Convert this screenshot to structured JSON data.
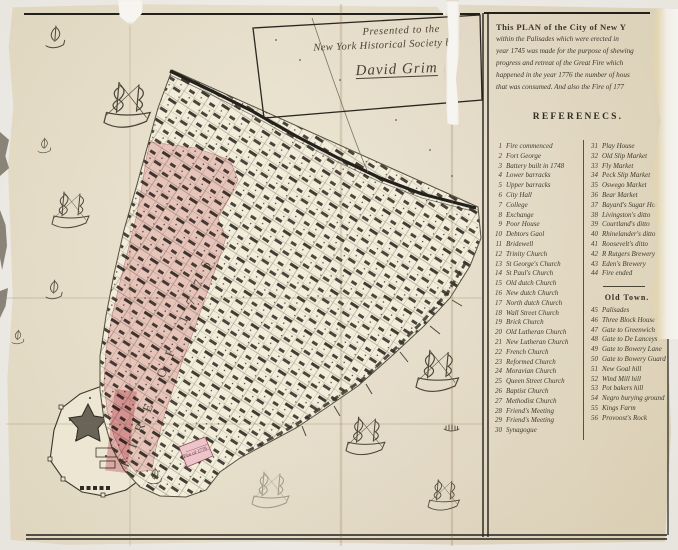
{
  "presentation_note": {
    "line1": "Presented to the",
    "line2": "New York Historical Society by",
    "signature": "David Grim"
  },
  "title_block": {
    "lines": [
      "This PLAN of the City of New Y",
      "within the Palisades which were erected in",
      "year 1745 was made for the purpose of shewing",
      "progress and retreat of the Great Fire which",
      "happened in the year 1776 the number of hous",
      "that was consumed. And also the Fire of 177"
    ]
  },
  "references": {
    "heading": "REFERENECS.",
    "left_column": [
      {
        "num": "1",
        "label": "Fire commenced"
      },
      {
        "num": "2",
        "label": "Fort George"
      },
      {
        "num": "3",
        "label": "Battery built in 1748"
      },
      {
        "num": "4",
        "label": "Lower barracks"
      },
      {
        "num": "5",
        "label": "Upper barracks"
      },
      {
        "num": "6",
        "label": "City Hall"
      },
      {
        "num": "7",
        "label": "College"
      },
      {
        "num": "8",
        "label": "Exchange"
      },
      {
        "num": "9",
        "label": "Poor House"
      },
      {
        "num": "10",
        "label": "Debtors Gaol"
      },
      {
        "num": "11",
        "label": "Bridewell"
      },
      {
        "num": "12",
        "label": "Trinity Church"
      },
      {
        "num": "13",
        "label": "St George's Church"
      },
      {
        "num": "14",
        "label": "St Paul's Church"
      },
      {
        "num": "15",
        "label": "Old dutch Church"
      },
      {
        "num": "16",
        "label": "New dutch Church"
      },
      {
        "num": "17",
        "label": "North dutch Church"
      },
      {
        "num": "18",
        "label": "Wall Street Church"
      },
      {
        "num": "19",
        "label": "Brick Church"
      },
      {
        "num": "20",
        "label": "Old Lutheran Church"
      },
      {
        "num": "21",
        "label": "New Lutheran Church"
      },
      {
        "num": "22",
        "label": "French Church"
      },
      {
        "num": "23",
        "label": "Reformed Church"
      },
      {
        "num": "24",
        "label": "Moravian Church"
      },
      {
        "num": "25",
        "label": "Queen Street Church"
      },
      {
        "num": "26",
        "label": "Baptist Church"
      },
      {
        "num": "27",
        "label": "Methodist Church"
      },
      {
        "num": "28",
        "label": "Friend's Meeting"
      },
      {
        "num": "29",
        "label": "Friend's Meeting"
      },
      {
        "num": "30",
        "label": "Synagogue"
      }
    ],
    "right_column": [
      {
        "num": "31",
        "label": "Play House"
      },
      {
        "num": "32",
        "label": "Old Slip Market"
      },
      {
        "num": "33",
        "label": "Fly Market"
      },
      {
        "num": "34",
        "label": "Peck Slip Market"
      },
      {
        "num": "35",
        "label": "Oswego Market"
      },
      {
        "num": "36",
        "label": "Bear Market"
      },
      {
        "num": "37",
        "label": "Bayard's Sugar House"
      },
      {
        "num": "38",
        "label": "Livingston's ditto"
      },
      {
        "num": "39",
        "label": "Courtland's ditto"
      },
      {
        "num": "40",
        "label": "Rhinelander's ditto"
      },
      {
        "num": "41",
        "label": "Roosevelt's ditto"
      },
      {
        "num": "42",
        "label": "R Rutgers Brewery"
      },
      {
        "num": "43",
        "label": "Eden's Brewery"
      },
      {
        "num": "44",
        "label": "Fire ended"
      }
    ],
    "old_town_heading": "Old Town.",
    "old_town_column": [
      {
        "num": "45",
        "label": "Palisades"
      },
      {
        "num": "46",
        "label": "Three Block Houses"
      },
      {
        "num": "47",
        "label": "Gate to Greenwich"
      },
      {
        "num": "48",
        "label": "Gate to De Lanceys"
      },
      {
        "num": "49",
        "label": "Gate to Bowery Lane"
      },
      {
        "num": "50",
        "label": "Gate to Bowery Guard house"
      },
      {
        "num": "51",
        "label": "New Goal hill"
      },
      {
        "num": "52",
        "label": "Wind Mill hill"
      },
      {
        "num": "53",
        "label": "Pot bakers hill"
      },
      {
        "num": "54",
        "label": "Negro burying ground"
      },
      {
        "num": "55",
        "label": "Kings Farm"
      },
      {
        "num": "56",
        "label": "Provoost's Rock"
      }
    ]
  },
  "map_labels": {
    "fire_1776": "FIRE OF 1776",
    "fire_1778": "Fire of 1778"
  },
  "colors": {
    "paper": "#e9e1cb",
    "burned_district_pink": "#eec4cb",
    "ink": "#3e392c",
    "frame_black": "#23211c"
  }
}
